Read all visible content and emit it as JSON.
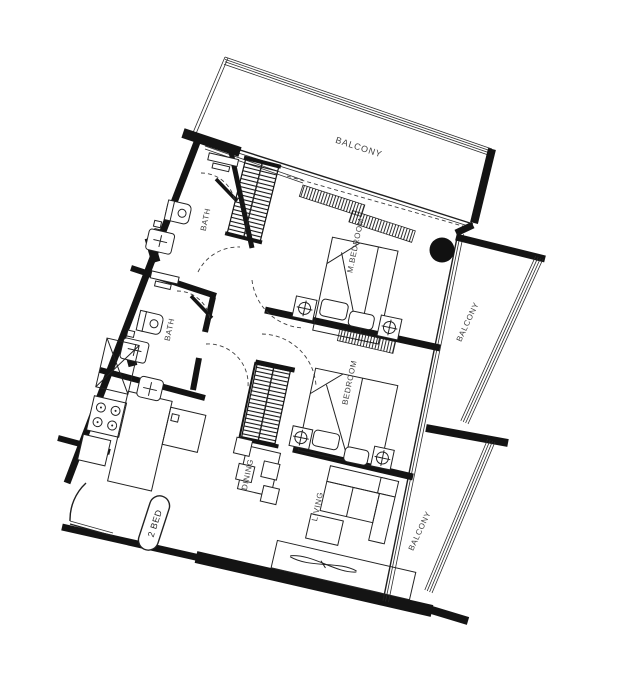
{
  "meta": {
    "unit_type_badge": "2 BED"
  },
  "colors": {
    "ink": "#141414",
    "label_text": "#3c3c3c",
    "background": "#ffffff"
  },
  "labels": {
    "balcony_top": "BALCONY",
    "balcony_right_upper": "BALCONY",
    "balcony_right_lower": "BALCONY",
    "m_bedroom": "M.BEDROOM",
    "bedroom": "BEDROOM",
    "bath_top": "BATH",
    "bath_lower": "BATH",
    "dining": "DINING",
    "living": "LIVING"
  }
}
